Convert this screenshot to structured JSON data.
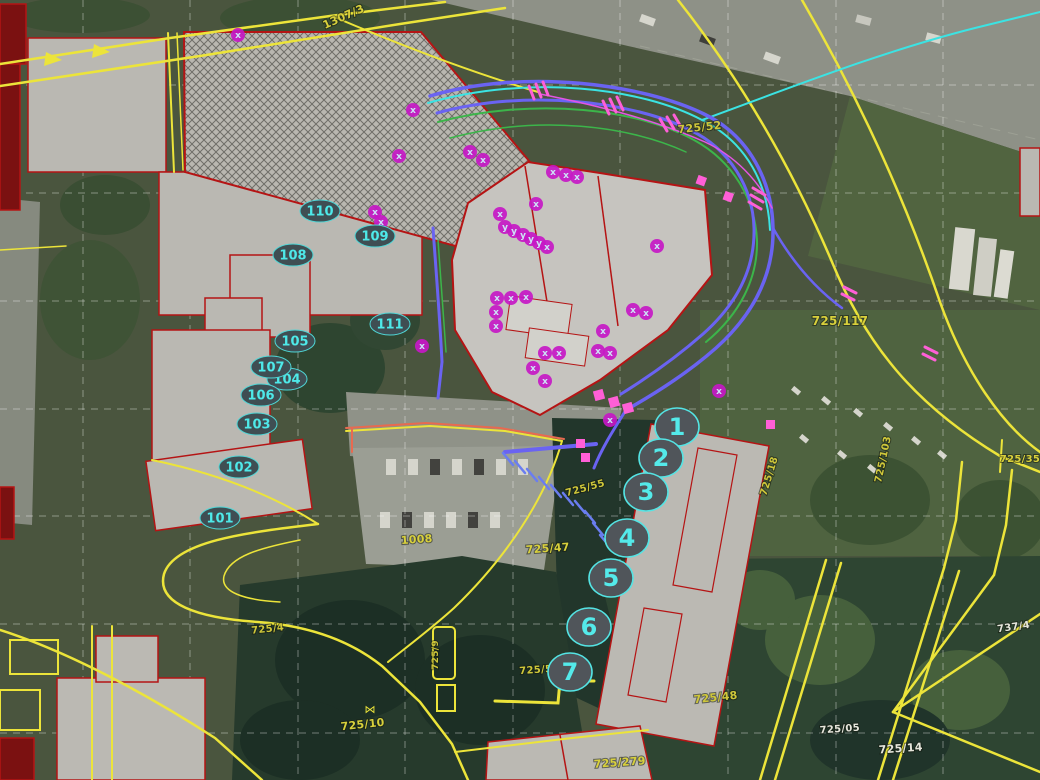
{
  "map": {
    "type": "gis-aerial-cadastral-view",
    "colors": {
      "cadastral_line": "#ece43a",
      "building_outline": "#b51414",
      "building_fill": "#bab8b2",
      "grid_line": "#ffffff",
      "utility_blue": "#6a63f2",
      "utility_green": "#3cb54a",
      "utility_cyan": "#3be3e3",
      "utility_pink": "#ff5fd7",
      "point_magenta": "#c518c5",
      "marker_ring": "#54e4e4",
      "marker_text": "#54eaea"
    },
    "grid": {
      "vertical_x": [
        83,
        190,
        298,
        405,
        513,
        620,
        728,
        836,
        943
      ],
      "horizontal_y": [
        85,
        193,
        301,
        409,
        516,
        624,
        733
      ]
    },
    "parcel_labels": [
      {
        "text": "1307/3",
        "x": 345,
        "y": 20,
        "rot": -24,
        "color": "#d8d03c",
        "size": 11
      },
      {
        "text": "725/52",
        "x": 700,
        "y": 131,
        "rot": -6,
        "color": "#cfc73a",
        "size": 11
      },
      {
        "text": "725/117",
        "x": 840,
        "y": 325,
        "rot": 0,
        "color": "#d8d03c",
        "size": 12
      },
      {
        "text": "725/35",
        "x": 1020,
        "y": 462,
        "rot": 0,
        "color": "#d8d03c",
        "size": 10
      },
      {
        "text": "725/103",
        "x": 886,
        "y": 460,
        "rot": -78,
        "color": "#cfc73a",
        "size": 10
      },
      {
        "text": "725/55",
        "x": 586,
        "y": 491,
        "rot": -15,
        "color": "#cfc73a",
        "size": 10
      },
      {
        "text": "725/18",
        "x": 772,
        "y": 477,
        "rot": -73,
        "color": "#cfc73a",
        "size": 10
      },
      {
        "text": "1008",
        "x": 417,
        "y": 543,
        "rot": -4,
        "color": "#d8d03c",
        "size": 11
      },
      {
        "text": "725/47",
        "x": 548,
        "y": 552,
        "rot": -4,
        "color": "#d8d03c",
        "size": 11
      },
      {
        "text": "725/4",
        "x": 268,
        "y": 632,
        "rot": -6,
        "color": "#cfc73a",
        "size": 10
      },
      {
        "text": "725/9",
        "x": 438,
        "y": 655,
        "rot": -90,
        "color": "#cfc73a",
        "size": 9
      },
      {
        "text": "725/5",
        "x": 536,
        "y": 673,
        "rot": -4,
        "color": "#cfc73a",
        "size": 10
      },
      {
        "text": "725/10",
        "x": 363,
        "y": 728,
        "rot": -6,
        "color": "#d8d03c",
        "size": 11
      },
      {
        "text": "725/279",
        "x": 620,
        "y": 766,
        "rot": -4,
        "color": "#d8d03c",
        "size": 11
      },
      {
        "text": "725/48",
        "x": 716,
        "y": 701,
        "rot": -6,
        "color": "#cfc73a",
        "size": 11
      },
      {
        "text": "737/4",
        "x": 1014,
        "y": 630,
        "rot": -8,
        "color": "#e6e6dc",
        "size": 10
      },
      {
        "text": "725/05",
        "x": 840,
        "y": 732,
        "rot": -4,
        "color": "#e6e6dc",
        "size": 10
      },
      {
        "text": "725/14",
        "x": 901,
        "y": 752,
        "rot": -4,
        "color": "#e6e6dc",
        "size": 11
      }
    ],
    "map_symbols": [
      {
        "glyph": "⋈",
        "x": 370,
        "y": 713,
        "color": "#ece43a",
        "size": 11
      }
    ],
    "survey_points": [
      {
        "label": "110",
        "x": 320,
        "y": 211
      },
      {
        "label": "109",
        "x": 375,
        "y": 236
      },
      {
        "label": "108",
        "x": 293,
        "y": 255
      },
      {
        "label": "111",
        "x": 390,
        "y": 324
      },
      {
        "label": "105",
        "x": 295,
        "y": 341
      },
      {
        "label": "104",
        "x": 287,
        "y": 379
      },
      {
        "label": "107",
        "x": 271,
        "y": 367
      },
      {
        "label": "106",
        "x": 261,
        "y": 395
      },
      {
        "label": "103",
        "x": 257,
        "y": 424
      },
      {
        "label": "102",
        "x": 239,
        "y": 467
      },
      {
        "label": "101",
        "x": 220,
        "y": 518
      }
    ],
    "route_points": [
      {
        "label": "1",
        "x": 677,
        "y": 427
      },
      {
        "label": "2",
        "x": 661,
        "y": 458
      },
      {
        "label": "3",
        "x": 646,
        "y": 492
      },
      {
        "label": "4",
        "x": 627,
        "y": 538
      },
      {
        "label": "5",
        "x": 611,
        "y": 578
      },
      {
        "label": "6",
        "x": 589,
        "y": 627
      },
      {
        "label": "7",
        "x": 570,
        "y": 672
      }
    ],
    "utility_points": [
      {
        "glyph": "x",
        "x": 238,
        "y": 35
      },
      {
        "glyph": "x",
        "x": 413,
        "y": 110
      },
      {
        "glyph": "x",
        "x": 399,
        "y": 156
      },
      {
        "glyph": "x",
        "x": 470,
        "y": 152
      },
      {
        "glyph": "x",
        "x": 483,
        "y": 160
      },
      {
        "glyph": "x",
        "x": 553,
        "y": 172
      },
      {
        "glyph": "x",
        "x": 566,
        "y": 175
      },
      {
        "glyph": "x",
        "x": 577,
        "y": 177
      },
      {
        "glyph": "x",
        "x": 375,
        "y": 212
      },
      {
        "glyph": "x",
        "x": 381,
        "y": 222
      },
      {
        "glyph": "x",
        "x": 536,
        "y": 204
      },
      {
        "glyph": "x",
        "x": 500,
        "y": 214
      },
      {
        "glyph": "y",
        "x": 505,
        "y": 227
      },
      {
        "glyph": "y",
        "x": 514,
        "y": 231
      },
      {
        "glyph": "y",
        "x": 523,
        "y": 235
      },
      {
        "glyph": "y",
        "x": 531,
        "y": 239
      },
      {
        "glyph": "y",
        "x": 539,
        "y": 243
      },
      {
        "glyph": "x",
        "x": 547,
        "y": 247
      },
      {
        "glyph": "x",
        "x": 657,
        "y": 246
      },
      {
        "glyph": "x",
        "x": 497,
        "y": 298
      },
      {
        "glyph": "x",
        "x": 511,
        "y": 298
      },
      {
        "glyph": "x",
        "x": 526,
        "y": 297
      },
      {
        "glyph": "x",
        "x": 496,
        "y": 312
      },
      {
        "glyph": "x",
        "x": 496,
        "y": 326
      },
      {
        "glyph": "x",
        "x": 633,
        "y": 310
      },
      {
        "glyph": "x",
        "x": 646,
        "y": 313
      },
      {
        "glyph": "x",
        "x": 603,
        "y": 331
      },
      {
        "glyph": "x",
        "x": 422,
        "y": 346
      },
      {
        "glyph": "x",
        "x": 545,
        "y": 353
      },
      {
        "glyph": "x",
        "x": 559,
        "y": 353
      },
      {
        "glyph": "x",
        "x": 598,
        "y": 351
      },
      {
        "glyph": "x",
        "x": 610,
        "y": 353
      },
      {
        "glyph": "x",
        "x": 533,
        "y": 368
      },
      {
        "glyph": "x",
        "x": 545,
        "y": 381
      },
      {
        "glyph": "x",
        "x": 719,
        "y": 391
      },
      {
        "glyph": "x",
        "x": 610,
        "y": 420
      }
    ],
    "styles": {
      "survey_marker": {
        "rx": 20,
        "ry": 11,
        "fill": "#3f4e53",
        "stroke": "#4fd6d6",
        "text": "#4ee9e9",
        "font": 13
      },
      "route_marker": {
        "rx": 22,
        "ry": 19,
        "fill": "#50555a",
        "stroke": "#54e4e4",
        "text": "#54eaea",
        "font": 24
      },
      "utility_marker": {
        "r": 7,
        "fill": "#c518c5",
        "text": "#cde4f7",
        "font": 9
      }
    }
  }
}
